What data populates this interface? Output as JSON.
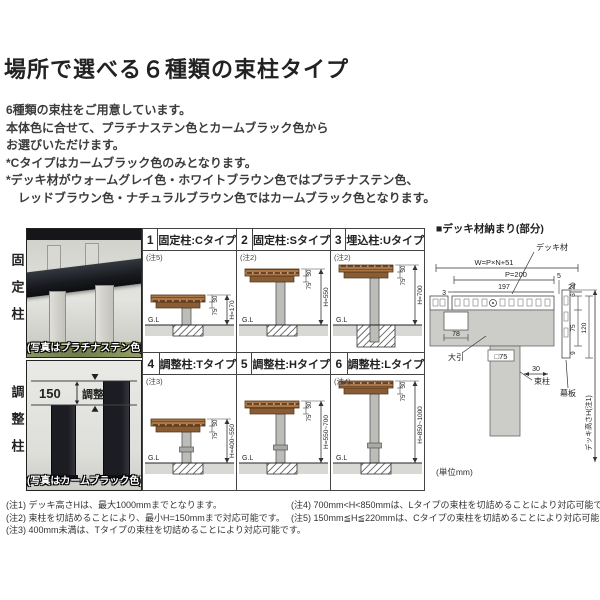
{
  "page": {
    "title": "場所で選べる６種類の束柱タイプ",
    "intro_lines": [
      "6種類の束柱をご用意しています。",
      "本体色に合せて、プラチナステン色とカームブラック色から",
      "お選びいただけます。",
      "*Cタイプはカームブラック色のみとなります。",
      "*デッキ材がウォームグレイ色・ホワイトブラウン色ではプラチナステン色、",
      "レッドブラウン色・ナチュラルブラウン色ではカームブラック色となります。"
    ]
  },
  "photos": {
    "fixed": {
      "side_label": "固定柱",
      "caption": "(写真はプラチナステン色)"
    },
    "adjust": {
      "side_label": "調整柱",
      "caption": "(写真はカームブラック色)",
      "adjust_value": "150",
      "adjust_label": "調整"
    }
  },
  "grid": {
    "cells": [
      {
        "num": "1",
        "title": "固定柱:Cタイプ",
        "note": "(注5)",
        "dim_board": "30",
        "dim_joist": "75",
        "dim_h": "H=170",
        "gl": "G.L"
      },
      {
        "num": "2",
        "title": "固定柱:Sタイプ",
        "note": "(注2)",
        "dim_board": "30",
        "dim_joist": "75",
        "dim_h": "H=550",
        "gl": "G.L"
      },
      {
        "num": "3",
        "title": "埋込柱:Uタイプ",
        "note": "(注2)",
        "dim_board": "30",
        "dim_joist": "75",
        "dim_h": "H=700",
        "gl": "G.L"
      },
      {
        "num": "4",
        "title": "調整柱:Tタイプ",
        "note": "(注3)",
        "dim_board": "30",
        "dim_joist": "75",
        "dim_h": "H=400~550",
        "gl": "G.L"
      },
      {
        "num": "5",
        "title": "調整柱:Hタイプ",
        "note": "",
        "dim_board": "30",
        "dim_joist": "75",
        "dim_h": "H=550~700",
        "gl": "G.L"
      },
      {
        "num": "6",
        "title": "調整柱:Lタイプ",
        "note": "(注4)",
        "dim_board": "30",
        "dim_joist": "75",
        "dim_h": "H=850~1000",
        "gl": "G.L"
      }
    ]
  },
  "detail": {
    "header": "■デッキ材納まり(部分)",
    "labels": {
      "deck_material": "デッキ材",
      "w_formula": "W=P×N+51",
      "pitch": "P=200",
      "gap5": "5",
      "d3": "3",
      "d197": "197",
      "d27": "27",
      "d30_top": "30",
      "d6": "6",
      "d120": "120",
      "d75": "75",
      "d9": "9",
      "d78": "78",
      "obiki": "大引",
      "d30_bottom": "30",
      "post_square": "□75",
      "makuita": "幕板",
      "tsuka": "束柱",
      "deck_height": "デッキ高さH(注1)",
      "unit": "(単位mm)"
    }
  },
  "notes": {
    "left": [
      "(注1) デッキ高さHは、最大1000mmまでとなります。",
      "(注2) 束柱を切詰めることにより、最小H=150mmまで対応可能です。",
      "(注3) 400mm未満は、Tタイプの束柱を切詰めることにより対応可能です。"
    ],
    "right": [
      "(注4) 700mm<H<850mmは、Lタイプの束柱を切詰めることにより対応可能です。",
      "(注5) 150mm≦H≦220mmは、Cタイプの束柱を切詰めることにより対応可能です。"
    ]
  },
  "colors": {
    "accent_red": "#cc1111",
    "deck_brown": "#aa7848",
    "post_gray": "#bcbcb8"
  }
}
